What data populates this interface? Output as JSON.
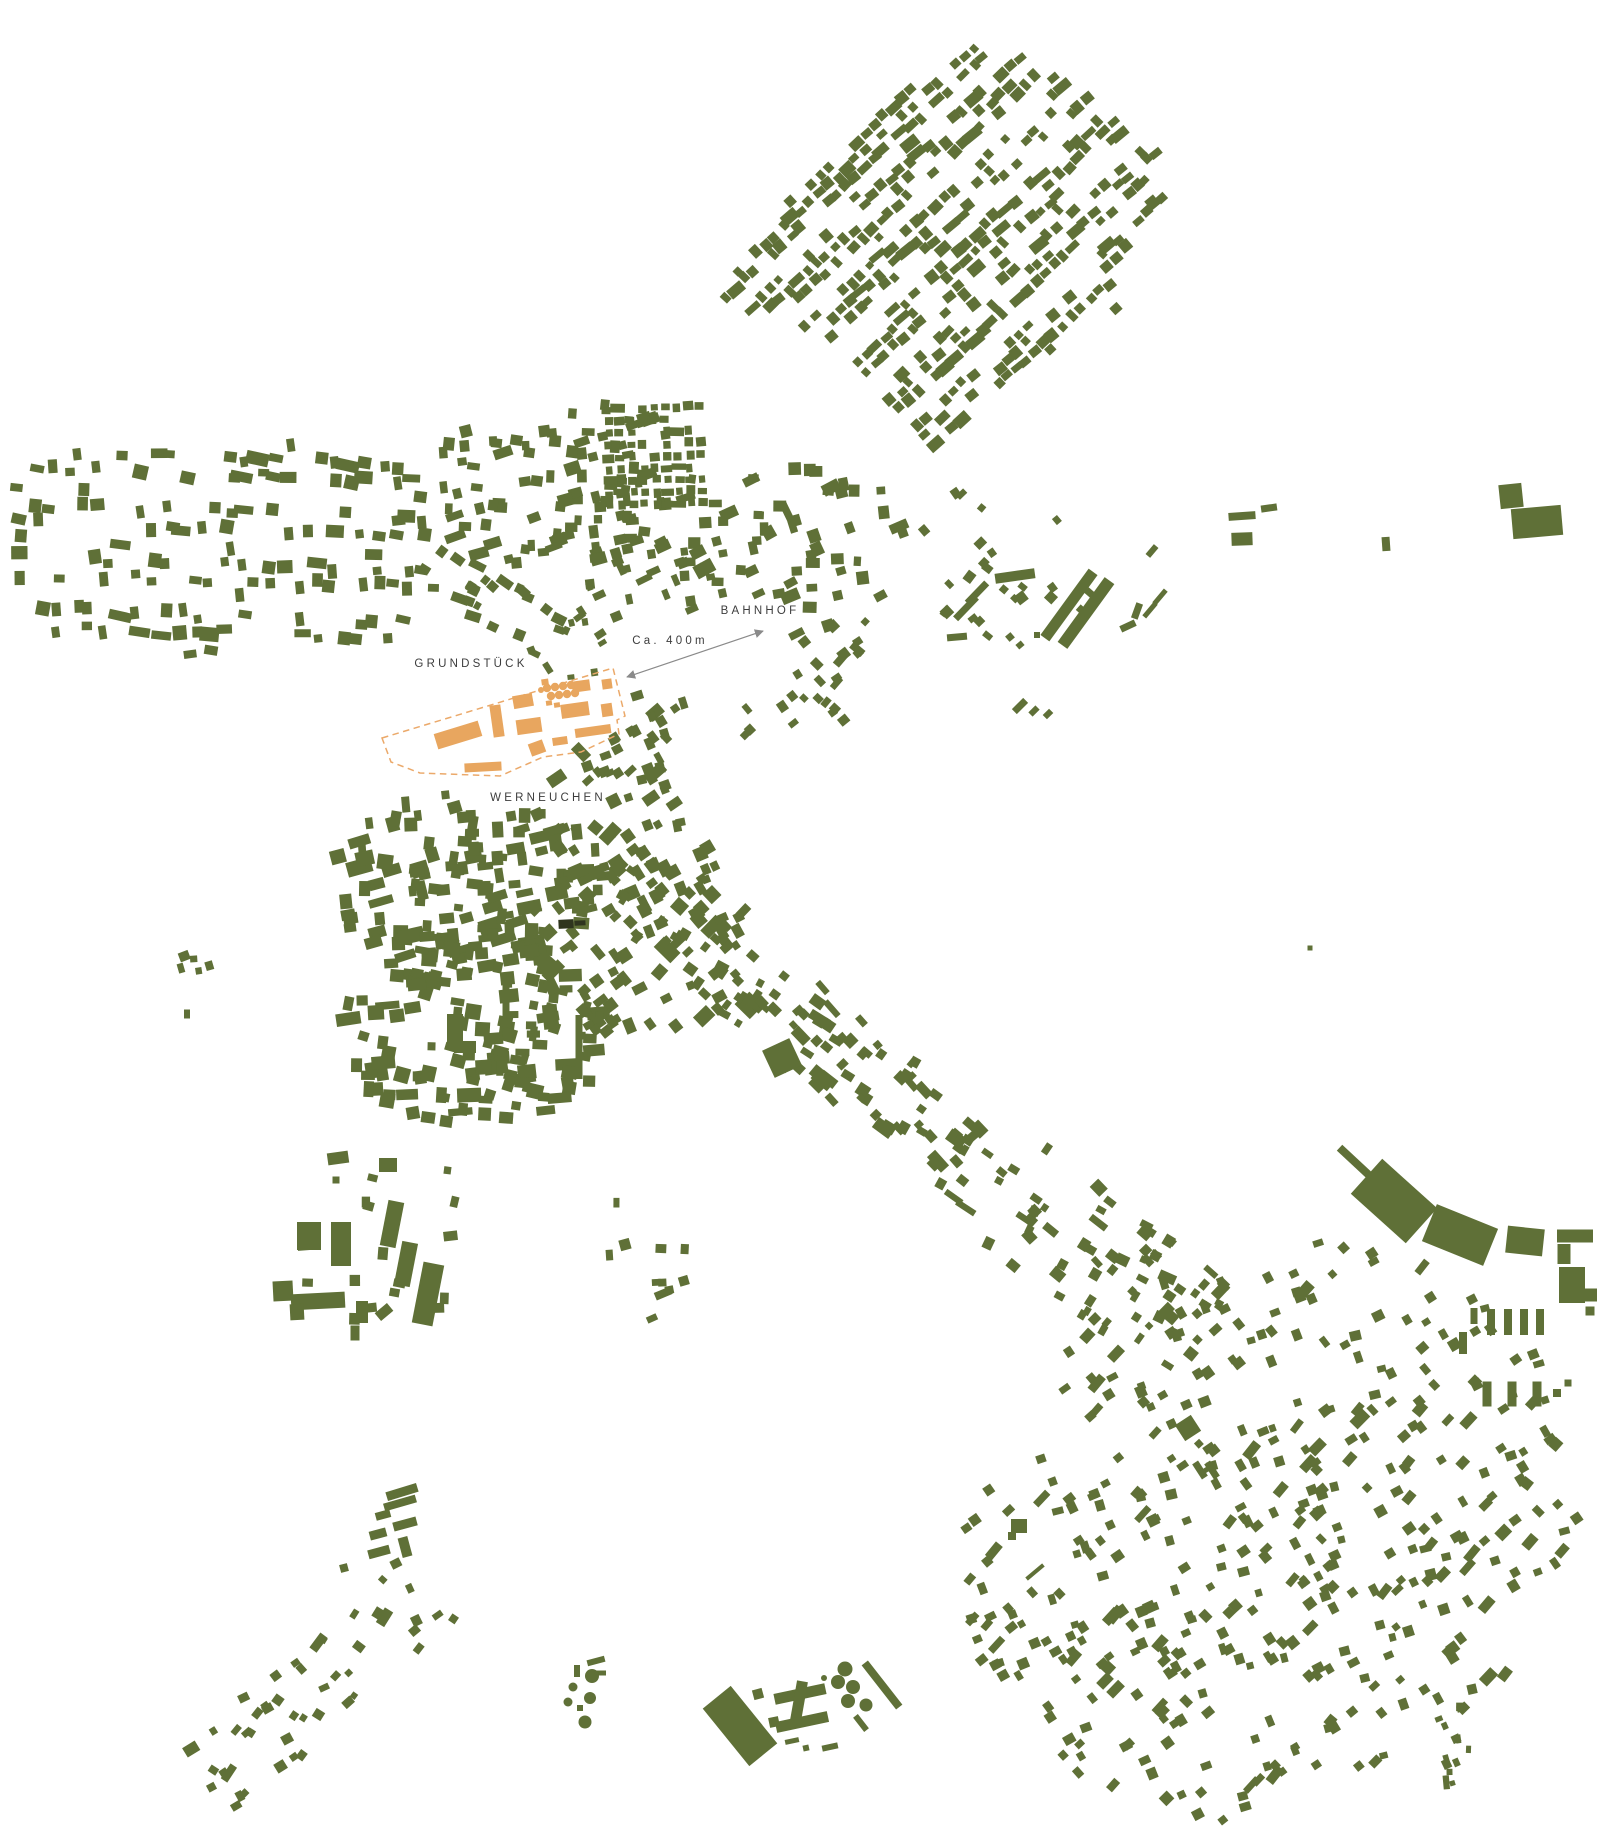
{
  "colors": {
    "background": "#ffffff",
    "building": "#5f7037",
    "site": "#e8a65f",
    "site_outline": "#eba96a",
    "dark_building": "#2f351e",
    "label": "#3d3d3d",
    "arrow": "#8a8a8a"
  },
  "canvas": {
    "width": 1600,
    "height": 1833
  },
  "labels": {
    "grundstueck": {
      "text": "GRUNDSTÜCK",
      "x": 471,
      "y": 667
    },
    "bahnhof": {
      "text": "BAHNHOF",
      "x": 760,
      "y": 614
    },
    "distance": {
      "text": "Ca. 400m",
      "x": 670,
      "y": 644
    },
    "werneuchen": {
      "text": "WERNEUCHEN",
      "x": 548,
      "y": 801
    }
  },
  "arrow": {
    "x1": 627,
    "y1": 677,
    "x2": 763,
    "y2": 631
  },
  "site": {
    "outline": [
      [
        382,
        738
      ],
      [
        613,
        668
      ],
      [
        625,
        716
      ],
      [
        617,
        720
      ],
      [
        619,
        734
      ],
      [
        581,
        752
      ],
      [
        543,
        757
      ],
      [
        500,
        776
      ],
      [
        420,
        773
      ],
      [
        391,
        762
      ]
    ],
    "buildings": [
      [
        458,
        735,
        46,
        16,
        -17
      ],
      [
        497,
        721,
        11,
        32,
        -8
      ],
      [
        523,
        701,
        20,
        13,
        -10
      ],
      [
        529,
        726,
        25,
        15,
        -8
      ],
      [
        581,
        686,
        18,
        11,
        -8
      ],
      [
        607,
        684,
        10,
        10,
        -8
      ],
      [
        607,
        710,
        11,
        13,
        -8
      ],
      [
        575,
        710,
        28,
        14,
        -8
      ],
      [
        593,
        731,
        36,
        9,
        -8
      ],
      [
        560,
        741,
        15,
        8,
        -8
      ],
      [
        537,
        748,
        15,
        13,
        -20
      ],
      [
        483,
        767,
        37,
        9,
        -3
      ],
      [
        545,
        682,
        7,
        6,
        -8
      ],
      [
        549,
        703,
        6,
        5,
        -8
      ],
      [
        557,
        705,
        6,
        5,
        -8
      ]
    ],
    "circles": [
      [
        547,
        688,
        4.2
      ],
      [
        555,
        687,
        4.2
      ],
      [
        563,
        686,
        4.2
      ],
      [
        571,
        685,
        4.2
      ],
      [
        551,
        696,
        4.2
      ],
      [
        559,
        695,
        4.2
      ],
      [
        567,
        694,
        4.2
      ],
      [
        575,
        693,
        4.2
      ],
      [
        541,
        690,
        3
      ]
    ]
  },
  "specials": {
    "rects": [
      [
        1069,
        605,
        82,
        11,
        -54
      ],
      [
        1086,
        613,
        80,
        12,
        -54
      ],
      [
        1015,
        576,
        40,
        10,
        -8
      ],
      [
        966,
        608,
        30,
        7,
        -46
      ],
      [
        977,
        593,
        28,
        7,
        -46
      ],
      [
        957,
        637,
        20,
        7,
        -5
      ],
      [
        1152,
        551,
        13,
        6,
        -50
      ],
      [
        1150,
        610,
        18,
        5,
        -50
      ],
      [
        1160,
        597,
        18,
        5,
        -50
      ],
      [
        1128,
        626,
        16,
        7,
        -25
      ],
      [
        1137,
        611,
        16,
        7,
        -70
      ],
      [
        1010,
        637,
        7,
        7,
        -40
      ],
      [
        1020,
        645,
        7,
        6,
        -40
      ],
      [
        1037,
        635,
        6,
        6,
        0
      ],
      [
        1020,
        706,
        16,
        7,
        -45
      ],
      [
        1034,
        711,
        10,
        6,
        -45
      ],
      [
        1048,
        714,
        9,
        6,
        -45
      ],
      [
        1242,
        516,
        27,
        8,
        -4
      ],
      [
        1269,
        508,
        16,
        7,
        -8
      ],
      [
        1242,
        539,
        21,
        13,
        -2
      ],
      [
        1386,
        544,
        8,
        14,
        -4
      ],
      [
        1511,
        496,
        23,
        24,
        -6
      ],
      [
        1537,
        522,
        50,
        30,
        -5
      ],
      [
        1356,
        1163,
        45,
        8,
        43
      ],
      [
        1394,
        1201,
        74,
        47,
        42
      ],
      [
        1460,
        1235,
        66,
        40,
        22
      ],
      [
        1525,
        1241,
        37,
        27,
        6
      ],
      [
        1575,
        1236,
        36,
        13,
        0
      ],
      [
        1564,
        1254,
        13,
        20,
        0
      ],
      [
        1572,
        1285,
        26,
        36,
        0
      ],
      [
        1591,
        1295,
        12,
        13,
        0
      ],
      [
        1474,
        1316,
        7,
        16,
        0
      ],
      [
        1491,
        1322,
        8,
        26,
        0
      ],
      [
        1508,
        1322,
        8,
        26,
        0
      ],
      [
        1524,
        1322,
        8,
        26,
        0
      ],
      [
        1540,
        1322,
        8,
        26,
        0
      ],
      [
        1590,
        1311,
        9,
        9,
        0
      ],
      [
        1463,
        1343,
        8,
        22,
        0
      ],
      [
        1487,
        1394,
        9,
        25,
        0
      ],
      [
        1512,
        1394,
        9,
        25,
        0
      ],
      [
        1537,
        1394,
        9,
        25,
        0
      ],
      [
        1557,
        1393,
        8,
        8,
        0
      ],
      [
        1568,
        1383,
        7,
        7,
        0
      ],
      [
        309,
        1236,
        24,
        28,
        0
      ],
      [
        341,
        1244,
        20,
        44,
        0
      ],
      [
        392,
        1224,
        16,
        46,
        11
      ],
      [
        406,
        1264,
        16,
        44,
        11
      ],
      [
        428,
        1294,
        21,
        62,
        11
      ],
      [
        283,
        1291,
        20,
        20,
        -3
      ],
      [
        318,
        1301,
        54,
        16,
        -3
      ],
      [
        297,
        1312,
        14,
        16,
        -3
      ],
      [
        362,
        1312,
        12,
        22,
        0
      ],
      [
        355,
        1333,
        9,
        15,
        0
      ],
      [
        384,
        1312,
        16,
        10,
        -40
      ],
      [
        338,
        1158,
        21,
        12,
        -8
      ],
      [
        388,
        1165,
        18,
        14,
        0
      ],
      [
        336,
        1180,
        7,
        7,
        0
      ],
      [
        402,
        1492,
        32,
        9,
        -17
      ],
      [
        400,
        1503,
        33,
        8,
        -16
      ],
      [
        383,
        1515,
        15,
        8,
        -15
      ],
      [
        405,
        1524,
        24,
        9,
        -15
      ],
      [
        378,
        1534,
        17,
        9,
        -15
      ],
      [
        405,
        1547,
        10,
        20,
        -15
      ],
      [
        379,
        1552,
        22,
        9,
        -15
      ],
      [
        344,
        1568,
        8,
        8,
        -15
      ],
      [
        740,
        1726,
        36,
        74,
        -39
      ],
      [
        800,
        1694,
        52,
        11,
        -12
      ],
      [
        799,
        1701,
        11,
        40,
        10
      ],
      [
        802,
        1722,
        53,
        11,
        -12
      ],
      [
        758,
        1694,
        10,
        10,
        -15
      ],
      [
        774,
        1722,
        10,
        10,
        -12
      ],
      [
        792,
        1741,
        14,
        5,
        -12
      ],
      [
        806,
        1748,
        6,
        6,
        -12
      ],
      [
        830,
        1747,
        16,
        6,
        -12
      ],
      [
        882,
        1685,
        8,
        56,
        -38
      ],
      [
        861,
        1723,
        6,
        18,
        -38
      ],
      [
        596,
        1661,
        18,
        6,
        -15
      ],
      [
        577,
        1671,
        6,
        12,
        0
      ],
      [
        600,
        1673,
        12,
        5,
        0
      ],
      [
        580,
        1708,
        6,
        6,
        0
      ],
      [
        579,
        1047,
        7,
        64,
        0
      ],
      [
        506,
        995,
        7,
        45,
        0
      ],
      [
        455,
        1032,
        16,
        36,
        0
      ],
      [
        465,
        1047,
        22,
        12,
        0
      ],
      [
        782,
        1058,
        30,
        30,
        -25
      ],
      [
        1188,
        1428,
        19,
        19,
        -33
      ],
      [
        1200,
        1470,
        7,
        18,
        -33
      ],
      [
        1212,
        1470,
        7,
        18,
        -33
      ],
      [
        1206,
        1470,
        12,
        5,
        -33
      ],
      [
        1019,
        1526,
        16,
        14,
        0
      ],
      [
        1012,
        1536,
        8,
        8,
        0
      ],
      [
        1035,
        1572,
        22,
        4,
        -40
      ],
      [
        1310,
        948,
        5,
        5,
        0
      ],
      [
        187,
        1014,
        6,
        9,
        0
      ]
    ],
    "circles": [
      [
        845,
        1669,
        7.5
      ],
      [
        838,
        1682,
        7
      ],
      [
        853,
        1687,
        7
      ],
      [
        848,
        1701,
        7
      ],
      [
        866,
        1705,
        6.5
      ],
      [
        824,
        1678,
        3
      ],
      [
        592,
        1676,
        7
      ],
      [
        573,
        1687,
        4.5
      ],
      [
        590,
        1698,
        6
      ],
      [
        568,
        1702,
        4.5
      ],
      [
        585,
        1722,
        6.5
      ]
    ],
    "dark_rects": [
      [
        566,
        924,
        15,
        9,
        -3
      ],
      [
        580,
        923,
        11,
        5,
        -3
      ]
    ]
  },
  "clusters": [
    {
      "name": "allotments-northeast",
      "type": "grid",
      "cx": 950,
      "cy": 242,
      "w": 560,
      "h": 560,
      "rot": -43,
      "sx": 12.5,
      "sy": 12.5,
      "skip": 0.34,
      "min": 6.5,
      "max": 12,
      "jit": 2.4,
      "rjit": 9,
      "seed": 11,
      "street": 4,
      "poly": [
        [
          985,
          38
        ],
        [
          1092,
          100
        ],
        [
          1182,
          170
        ],
        [
          1118,
          308
        ],
        [
          942,
          452
        ],
        [
          808,
          332
        ],
        [
          714,
          298
        ],
        [
          842,
          132
        ]
      ]
    },
    {
      "name": "west-band",
      "type": "grid",
      "cx": 228,
      "cy": 546,
      "w": 436,
      "h": 222,
      "rot": 2,
      "sx": 15,
      "sy": 17.5,
      "skip": 0.42,
      "min": 7.5,
      "max": 14.5,
      "jit": 4.5,
      "rjit": 22,
      "seed": 22,
      "street": 3,
      "shape": "super"
    },
    {
      "name": "north-center",
      "type": "scatter",
      "cx": 560,
      "cy": 480,
      "w": 270,
      "h": 175,
      "rot": -6,
      "count": 145,
      "min": 7,
      "max": 13,
      "rjit": 30,
      "seed": 33,
      "fade": 0.35
    },
    {
      "name": "grid-northeast-of-site",
      "type": "grid",
      "cx": 655,
      "cy": 456,
      "w": 114,
      "h": 98,
      "rot": -2,
      "sx": 11.5,
      "sy": 12,
      "skip": 0.15,
      "min": 6,
      "max": 9.5,
      "jit": 1.4,
      "rjit": 7,
      "seed": 44
    },
    {
      "name": "bahnhof-surroundings",
      "type": "scatter",
      "cx": 802,
      "cy": 548,
      "w": 225,
      "h": 170,
      "rot": -12,
      "count": 100,
      "min": 7,
      "max": 14,
      "rjit": 35,
      "seed": 55,
      "fade": 0.3
    },
    {
      "name": "east-of-station",
      "type": "scatter",
      "cx": 1012,
      "cy": 565,
      "w": 195,
      "h": 195,
      "rot": -45,
      "count": 48,
      "min": 6,
      "max": 11,
      "rjit": 25,
      "seed": 66,
      "fade": 0.4
    },
    {
      "name": "southeast-of-arrow",
      "type": "scatter",
      "cx": 815,
      "cy": 688,
      "w": 180,
      "h": 95,
      "rot": -40,
      "count": 33,
      "min": 6,
      "max": 11,
      "rjit": 25,
      "seed": 77,
      "fade": 0.2
    },
    {
      "name": "south-of-site",
      "type": "scatter",
      "cx": 612,
      "cy": 806,
      "w": 170,
      "h": 130,
      "rot": -25,
      "count": 52,
      "min": 7,
      "max": 13,
      "rjit": 30,
      "seed": 88,
      "fade": 0.2
    },
    {
      "name": "town-northwest",
      "type": "scatter",
      "cx": 470,
      "cy": 882,
      "w": 285,
      "h": 180,
      "rot": -4,
      "count": 190,
      "min": 7,
      "max": 16,
      "rjit": 28,
      "seed": 99,
      "fade": 0.22,
      "elong": 0.3
    },
    {
      "name": "town-southwest",
      "type": "scatter",
      "cx": 472,
      "cy": 1030,
      "w": 270,
      "h": 195,
      "rot": 4,
      "count": 175,
      "min": 7,
      "max": 16,
      "rjit": 28,
      "seed": 110,
      "fade": 0.22,
      "elong": 0.3
    },
    {
      "name": "town-northeast",
      "type": "scatter",
      "cx": 640,
      "cy": 930,
      "w": 215,
      "h": 235,
      "rot": -35,
      "count": 130,
      "min": 7,
      "max": 15,
      "rjit": 30,
      "seed": 121,
      "fade": 0.2,
      "elong": 0.25
    },
    {
      "name": "north-of-town",
      "type": "scatter",
      "cx": 635,
      "cy": 716,
      "w": 190,
      "h": 130,
      "rot": -30,
      "count": 62,
      "min": 6,
      "max": 12,
      "rjit": 30,
      "seed": 132,
      "fade": 0.25
    },
    {
      "name": "main-street",
      "type": "strip",
      "x1": 618,
      "y1": 878,
      "x2": 1005,
      "y2": 1188,
      "width": 85,
      "count": 115,
      "min": 6,
      "max": 13,
      "rjit": 22,
      "seed": 143,
      "elong": 0.35
    },
    {
      "name": "corridor-southeast",
      "type": "strip",
      "x1": 1005,
      "y1": 1188,
      "x2": 1218,
      "y2": 1348,
      "width": 115,
      "count": 65,
      "min": 6,
      "max": 12,
      "rjit": 26,
      "seed": 154,
      "elong": 0.3
    },
    {
      "name": "suburb-southeast",
      "type": "scatter",
      "cx": 1272,
      "cy": 1532,
      "w": 650,
      "h": 545,
      "rot": -33,
      "count": 720,
      "min": 6.5,
      "max": 11.5,
      "rjit": 40,
      "seed": 165,
      "fade": 0.5
    },
    {
      "name": "suburb-tail",
      "type": "strip",
      "x1": 1447,
      "y1": 1706,
      "x2": 1468,
      "y2": 1812,
      "width": 42,
      "count": 13,
      "min": 5,
      "max": 9,
      "rjit": 30,
      "seed": 176
    },
    {
      "name": "industrial-southwest-scatter",
      "type": "scatter",
      "cx": 382,
      "cy": 1237,
      "w": 195,
      "h": 195,
      "rot": 5,
      "count": 25,
      "min": 7,
      "max": 13,
      "rjit": 25,
      "seed": 187,
      "fade": 0.5
    },
    {
      "name": "southwest-diagonal",
      "type": "strip",
      "x1": 452,
      "y1": 1568,
      "x2": 206,
      "y2": 1788,
      "width": 85,
      "count": 46,
      "min": 6,
      "max": 11,
      "rjit": 35,
      "seed": 198
    },
    {
      "name": "south-of-town-sparse",
      "type": "scatter",
      "cx": 640,
      "cy": 1255,
      "w": 115,
      "h": 155,
      "rot": -10,
      "count": 16,
      "min": 6,
      "max": 11,
      "rjit": 30,
      "seed": 209,
      "fade": 0.2
    },
    {
      "name": "west-hamlet",
      "type": "scatter",
      "cx": 198,
      "cy": 965,
      "w": 48,
      "h": 42,
      "rot": -10,
      "count": 8,
      "min": 6,
      "max": 10,
      "rjit": 30,
      "seed": 220,
      "fade": 0
    },
    {
      "name": "northeast-of-site-dots",
      "type": "scatter",
      "cx": 576,
      "cy": 645,
      "w": 95,
      "h": 72,
      "rot": -20,
      "count": 16,
      "min": 5,
      "max": 8,
      "rjit": 35,
      "seed": 242,
      "fade": 0
    },
    {
      "name": "road-to-site",
      "type": "strip",
      "x1": 428,
      "y1": 562,
      "x2": 560,
      "y2": 642,
      "width": 52,
      "count": 24,
      "min": 6,
      "max": 11,
      "rjit": 28,
      "seed": 253
    },
    {
      "name": "station-row-west",
      "type": "scatter",
      "cx": 655,
      "cy": 580,
      "w": 135,
      "h": 85,
      "rot": -15,
      "count": 35,
      "min": 6,
      "max": 11,
      "rjit": 25,
      "seed": 264,
      "fade": 0.15
    }
  ]
}
